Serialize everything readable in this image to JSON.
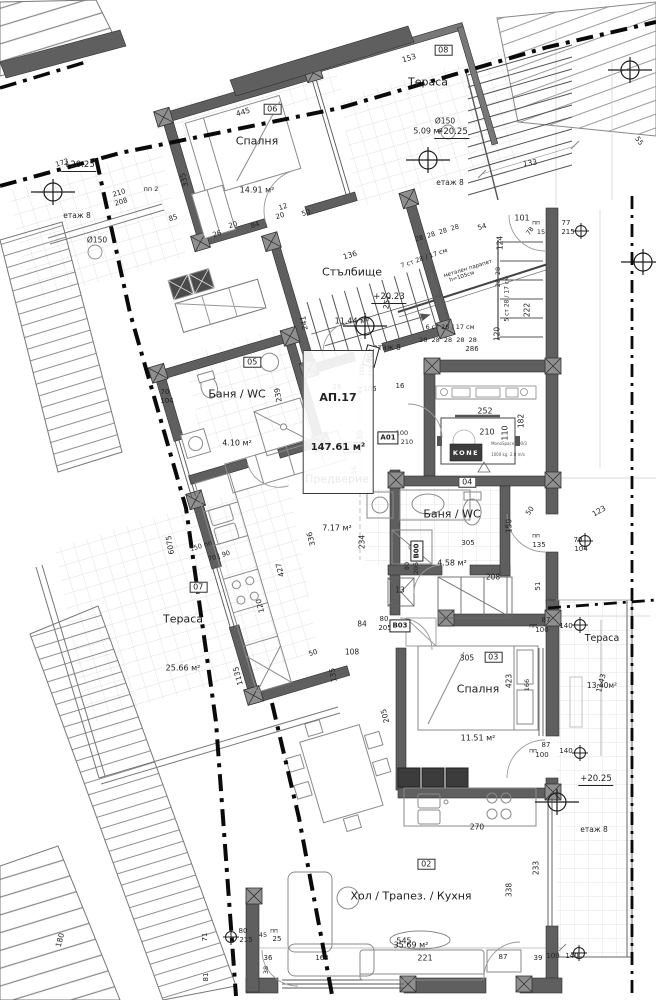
{
  "plan": {
    "apartment": {
      "code": "АП.17",
      "area": "147.61 м²",
      "x": 338,
      "y": 422
    },
    "rooms": [
      {
        "num": "06",
        "name": "Спалня",
        "area": "14.91 м²",
        "x": 257,
        "y": 156
      },
      {
        "num": "08",
        "name": "Тераса",
        "area": "5.09 м²",
        "x": 428,
        "y": 97
      },
      {
        "num": "",
        "name": "Стълбище",
        "area": "11.44 м²",
        "x": 352,
        "y": 287
      },
      {
        "num": "05",
        "name": "Баня / WC",
        "area": "4.10 м²",
        "x": 237,
        "y": 409
      },
      {
        "num": "01",
        "name": "Предверие",
        "area": "7.17 м²",
        "x": 337,
        "y": 494
      },
      {
        "num": "04",
        "name": "Баня / WC",
        "area": "4.58 м²",
        "x": 452,
        "y": 529
      },
      {
        "num": "07",
        "name": "Тераса",
        "area": "25.66 м²",
        "x": 183,
        "y": 634
      },
      {
        "num": "03",
        "name": "Спалня",
        "area": "11.51 м²",
        "x": 478,
        "y": 704
      },
      {
        "num": "",
        "name": "Тераса",
        "area": "13.40м²",
        "x": 602,
        "y": 652,
        "cls": "small"
      },
      {
        "num": "02",
        "name": "Хол / Трапез. / Кухня",
        "area": "35.69 м²",
        "x": 411,
        "y": 911
      }
    ],
    "elevation_marks": [
      {
        "value": "+20.25",
        "floor": "етаж 8",
        "x": 79,
        "y": 190
      },
      {
        "value": "+20.25",
        "floor": "етаж 8",
        "x": 452,
        "y": 157
      },
      {
        "value": "+20.23",
        "floor": "етаж 8",
        "x": 389,
        "y": 322
      },
      {
        "value": "+20.25",
        "floor": "етаж 8",
        "x": 596,
        "y": 804
      }
    ],
    "door_tags": [
      {
        "code": "A01",
        "x": 388,
        "y": 438
      },
      {
        "code": "B01",
        "x": 371,
        "y": 356,
        "r": -75
      },
      {
        "code": "B00",
        "x": 417,
        "y": 551,
        "r": -90
      },
      {
        "code": "B03",
        "x": 400,
        "y": 626
      }
    ],
    "elevator": {
      "brand": "KONE",
      "model": "MonoSpace 300/3",
      "spec": "1000 kg  2.8 m/s"
    },
    "dims": [
      {
        "t": "153",
        "x": 409,
        "y": 58,
        "r": -17
      },
      {
        "t": "445",
        "x": 243,
        "y": 112,
        "r": -17
      },
      {
        "t": "335",
        "x": 184,
        "y": 180,
        "r": -105
      },
      {
        "t": "Ø150",
        "x": 445,
        "y": 121
      },
      {
        "t": "Ø150",
        "x": 97,
        "y": 240
      },
      {
        "t": "133",
        "x": 530,
        "y": 163,
        "r": -8
      },
      {
        "t": "55",
        "x": 639,
        "y": 141,
        "r": 55,
        "fs": 7
      },
      {
        "t": "173",
        "x": 62,
        "y": 163,
        "r": -17,
        "fs": 7
      },
      {
        "t": "210",
        "x": 119,
        "y": 193,
        "r": -17,
        "fs": 7
      },
      {
        "t": "208",
        "x": 121,
        "y": 202,
        "r": -17,
        "fs": 7
      },
      {
        "t": "пп 2",
        "x": 151,
        "y": 189,
        "fs": 6.5
      },
      {
        "t": "85",
        "x": 173,
        "y": 218,
        "r": -17,
        "fs": 7
      },
      {
        "t": "12",
        "x": 283,
        "y": 207,
        "r": -17,
        "fs": 7
      },
      {
        "t": "20",
        "x": 280,
        "y": 216,
        "r": -17,
        "fs": 7
      },
      {
        "t": "50",
        "x": 306,
        "y": 213,
        "r": -17,
        "fs": 7
      },
      {
        "t": "84",
        "x": 255,
        "y": 225,
        "r": -17,
        "fs": 7
      },
      {
        "t": "20",
        "x": 233,
        "y": 225,
        "r": -17,
        "fs": 7
      },
      {
        "t": "26",
        "x": 217,
        "y": 234,
        "r": -17,
        "fs": 7
      },
      {
        "t": "54",
        "x": 482,
        "y": 227,
        "r": -17,
        "fs": 7
      },
      {
        "t": "28  28  28  28",
        "x": 437,
        "y": 233,
        "r": -17,
        "fs": 6.5
      },
      {
        "t": "7 ст 28 / 17 см",
        "x": 424,
        "y": 258,
        "r": -19,
        "fs": 6.5
      },
      {
        "t": "101",
        "x": 522,
        "y": 218,
        "fs": 8
      },
      {
        "t": "пп",
        "x": 536,
        "y": 223,
        "fs": 6
      },
      {
        "t": "78",
        "x": 530,
        "y": 231,
        "r": -55,
        "fs": 6.5
      },
      {
        "t": "15",
        "x": 541,
        "y": 232,
        "fs": 6.5
      },
      {
        "t": "77",
        "x": 566,
        "y": 223,
        "fs": 7
      },
      {
        "t": "215",
        "x": 568,
        "y": 232,
        "fs": 7
      },
      {
        "t": "124",
        "x": 500,
        "y": 243,
        "r": -90
      },
      {
        "t": "28",
        "x": 498,
        "y": 271,
        "r": -90,
        "fs": 6.5
      },
      {
        "t": "28",
        "x": 498,
        "y": 283,
        "r": -90,
        "fs": 6.5
      },
      {
        "t": "5 ст 28 / 17 см",
        "x": 507,
        "y": 299,
        "r": -90,
        "fs": 6
      },
      {
        "t": "222",
        "x": 527,
        "y": 310,
        "r": -90
      },
      {
        "t": "120",
        "x": 497,
        "y": 334,
        "r": -90
      },
      {
        "t": "136",
        "x": 350,
        "y": 255,
        "r": -17
      },
      {
        "t": "241",
        "x": 304,
        "y": 323,
        "r": -100
      },
      {
        "t": "251",
        "x": 387,
        "y": 302,
        "r": -80
      },
      {
        "t": "метален парапет",
        "x": 468,
        "y": 269,
        "r": -17,
        "fs": 5.5
      },
      {
        "t": "h=105см",
        "x": 462,
        "y": 277,
        "r": -17,
        "fs": 5.5
      },
      {
        "t": "6 ст 28 / 17 см",
        "x": 450,
        "y": 327,
        "fs": 6.5
      },
      {
        "t": "28  28  28  28  28",
        "x": 448,
        "y": 340,
        "fs": 6.5
      },
      {
        "t": "286",
        "x": 472,
        "y": 349,
        "fs": 7
      },
      {
        "t": "26",
        "x": 337,
        "y": 387,
        "fs": 7
      },
      {
        "t": "49",
        "x": 360,
        "y": 390,
        "r": -90,
        "fs": 6.5
      },
      {
        "t": "105",
        "x": 370,
        "y": 389,
        "fs": 7
      },
      {
        "t": "16",
        "x": 400,
        "y": 386,
        "fs": 7
      },
      {
        "t": "239",
        "x": 278,
        "y": 395,
        "r": -100
      },
      {
        "t": "70",
        "x": 165,
        "y": 392,
        "fs": 7
      },
      {
        "t": "104",
        "x": 167,
        "y": 401,
        "fs": 7
      },
      {
        "t": "252",
        "x": 485,
        "y": 411,
        "fs": 8
      },
      {
        "t": "210",
        "x": 487,
        "y": 432,
        "fs": 8
      },
      {
        "t": "110",
        "x": 505,
        "y": 433,
        "r": -90,
        "fs": 8
      },
      {
        "t": "182",
        "x": 521,
        "y": 421,
        "r": -90
      },
      {
        "t": "130",
        "x": 360,
        "y": 438,
        "r": -90
      },
      {
        "t": "16",
        "x": 354,
        "y": 470,
        "r": -90,
        "fs": 6.5
      },
      {
        "t": "234",
        "x": 362,
        "y": 542,
        "r": -90
      },
      {
        "t": "150",
        "x": 509,
        "y": 526,
        "r": -90
      },
      {
        "t": "50",
        "x": 530,
        "y": 511,
        "r": -55,
        "fs": 7
      },
      {
        "t": "305",
        "x": 468,
        "y": 543,
        "fs": 7
      },
      {
        "t": "пп",
        "x": 536,
        "y": 536,
        "fs": 6
      },
      {
        "t": "135",
        "x": 539,
        "y": 545,
        "fs": 7
      },
      {
        "t": "70",
        "x": 578,
        "y": 540,
        "fs": 7
      },
      {
        "t": "104",
        "x": 581,
        "y": 549,
        "fs": 7
      },
      {
        "t": "123",
        "x": 599,
        "y": 511,
        "r": -30
      },
      {
        "t": "51",
        "x": 538,
        "y": 586,
        "r": -90,
        "fs": 7
      },
      {
        "t": "208",
        "x": 493,
        "y": 577
      },
      {
        "t": "13",
        "x": 400,
        "y": 590
      },
      {
        "t": "336",
        "x": 311,
        "y": 539,
        "r": -105
      },
      {
        "t": "427",
        "x": 280,
        "y": 570,
        "r": -105
      },
      {
        "t": "150 пп",
        "x": 201,
        "y": 546,
        "r": -17,
        "fs": 6.5
      },
      {
        "t": "70 | 90",
        "x": 219,
        "y": 556,
        "r": -17,
        "fs": 6.5
      },
      {
        "t": "120",
        "x": 260,
        "y": 606,
        "r": -105
      },
      {
        "t": "6075",
        "x": 170,
        "y": 545,
        "r": -100
      },
      {
        "t": "84",
        "x": 362,
        "y": 624
      },
      {
        "t": "80",
        "x": 384,
        "y": 619,
        "fs": 7
      },
      {
        "t": "205",
        "x": 385,
        "y": 628,
        "fs": 7
      },
      {
        "t": "108",
        "x": 352,
        "y": 652
      },
      {
        "t": "50",
        "x": 313,
        "y": 653,
        "r": -17,
        "fs": 7
      },
      {
        "t": "135",
        "x": 333,
        "y": 675,
        "r": -100
      },
      {
        "t": "305",
        "x": 467,
        "y": 658
      },
      {
        "t": "423",
        "x": 509,
        "y": 681,
        "r": -90
      },
      {
        "t": "166",
        "x": 527,
        "y": 685,
        "r": -90,
        "fs": 6.5
      },
      {
        "t": "87",
        "x": 546,
        "y": 620,
        "fs": 7
      },
      {
        "t": "пп",
        "x": 533,
        "y": 626,
        "fs": 6
      },
      {
        "t": "100",
        "x": 542,
        "y": 630,
        "fs": 7
      },
      {
        "t": "140",
        "x": 566,
        "y": 626,
        "fs": 7
      },
      {
        "t": "87",
        "x": 546,
        "y": 745,
        "fs": 7
      },
      {
        "t": "пп",
        "x": 533,
        "y": 751,
        "fs": 6
      },
      {
        "t": "100",
        "x": 542,
        "y": 755,
        "fs": 7
      },
      {
        "t": "140",
        "x": 566,
        "y": 751,
        "fs": 7
      },
      {
        "t": "1143",
        "x": 601,
        "y": 683,
        "r": -75
      },
      {
        "t": "205",
        "x": 385,
        "y": 716,
        "r": -105
      },
      {
        "t": "1135",
        "x": 238,
        "y": 676,
        "r": -105
      },
      {
        "t": "233",
        "x": 536,
        "y": 868,
        "r": -90
      },
      {
        "t": "270",
        "x": 477,
        "y": 827
      },
      {
        "t": "338",
        "x": 509,
        "y": 890,
        "r": -90
      },
      {
        "t": "545",
        "x": 404,
        "y": 941,
        "fs": 8
      },
      {
        "t": "221",
        "x": 425,
        "y": 958,
        "fs": 8
      },
      {
        "t": "87",
        "x": 503,
        "y": 957,
        "fs": 7
      },
      {
        "t": "39",
        "x": 538,
        "y": 958,
        "fs": 7
      },
      {
        "t": "100",
        "x": 553,
        "y": 956,
        "fs": 7
      },
      {
        "t": "140",
        "x": 572,
        "y": 956,
        "fs": 7
      },
      {
        "t": "80",
        "x": 243,
        "y": 931,
        "fs": 7
      },
      {
        "t": "215",
        "x": 246,
        "y": 940,
        "fs": 7
      },
      {
        "t": "пп",
        "x": 274,
        "y": 931,
        "fs": 6
      },
      {
        "t": "25",
        "x": 277,
        "y": 939,
        "fs": 7
      },
      {
        "t": "45",
        "x": 263,
        "y": 935,
        "fs": 6.5
      },
      {
        "t": "36",
        "x": 268,
        "y": 958,
        "fs": 7
      },
      {
        "t": "38",
        "x": 266,
        "y": 970,
        "r": -90,
        "fs": 6.5
      },
      {
        "t": "163",
        "x": 322,
        "y": 958,
        "fs": 7
      },
      {
        "t": "71",
        "x": 205,
        "y": 937,
        "r": -90,
        "fs": 7
      },
      {
        "t": "81",
        "x": 206,
        "y": 977,
        "r": -90,
        "fs": 7
      },
      {
        "t": "180",
        "x": 60,
        "y": 940,
        "r": -75
      },
      {
        "t": "100",
        "x": 402,
        "y": 433,
        "fs": 6.5
      },
      {
        "t": "210",
        "x": 407,
        "y": 442,
        "fs": 6.5
      },
      {
        "t": "100",
        "x": 362,
        "y": 370,
        "r": -90,
        "fs": 6.5
      },
      {
        "t": "210",
        "x": 371,
        "y": 371,
        "r": -90,
        "fs": 6.5
      },
      {
        "t": "80",
        "x": 407,
        "y": 566,
        "r": -90,
        "fs": 6.5
      },
      {
        "t": "205",
        "x": 416,
        "y": 568,
        "r": -90,
        "fs": 6.5
      }
    ]
  }
}
